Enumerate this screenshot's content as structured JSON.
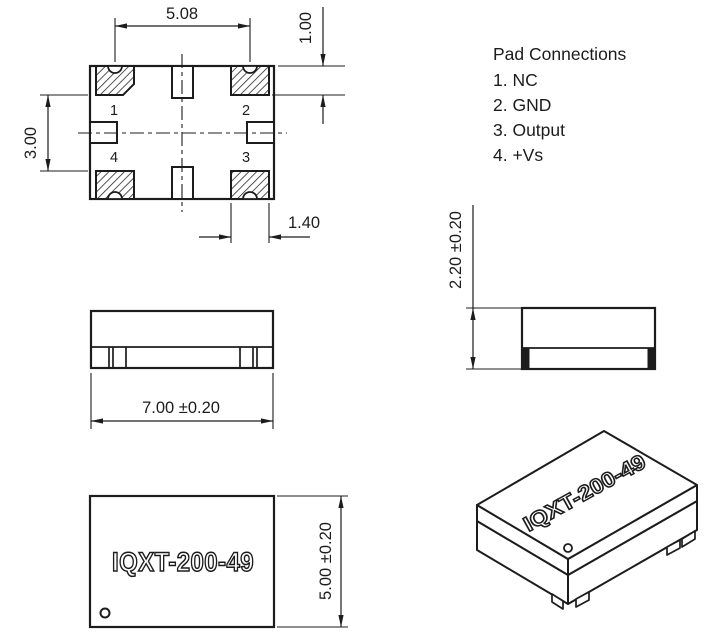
{
  "part_number": "IQXT-200-49",
  "pad_connections": {
    "title": "Pad Connections",
    "items": [
      "1. NC",
      "2. GND",
      "3. Output",
      "4. +Vs"
    ]
  },
  "pad_labels": {
    "p1": "1",
    "p2": "2",
    "p3": "3",
    "p4": "4"
  },
  "dimensions": {
    "pad_span_horizontal": "5.08",
    "pad_height": "1.00",
    "pad_span_vertical": "3.00",
    "pad_width": "1.40",
    "body_length": "7.00 ±0.20",
    "body_height": "2.20 ±0.20",
    "body_width": "5.00 ±0.20"
  },
  "colors": {
    "line": "#1c1c1c",
    "background": "#ffffff"
  }
}
